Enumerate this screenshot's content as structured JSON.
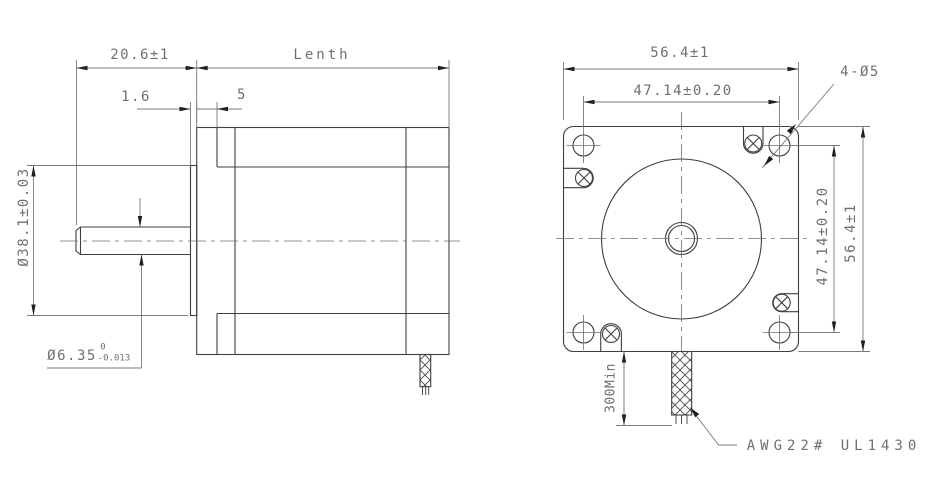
{
  "drawing_type": "stepper-motor-dimension-drawing",
  "colors": {
    "background": "#ffffff",
    "part_line": "#3f3f3f",
    "dim_line": "#7a7a7a",
    "text": "#6f6f6f",
    "arrow": "#1f1f1f"
  },
  "side_view": {
    "shaft_length": "20.6±1",
    "length_label": "Lenth",
    "pilot_depth": "1.6",
    "front_cap_depth": "5",
    "pilot_diameter": "Ø38.1±0.03",
    "shaft_diameter": "Ø6.35",
    "shaft_tol_upper": "0",
    "shaft_tol_lower": "-0.013"
  },
  "front_view": {
    "width": "56.4±1",
    "hole_spacing_horizontal": "47.14±0.20",
    "hole_spacing_vertical": "47.14±0.20",
    "height": "56.4±1",
    "mounting_holes": "4-Ø5",
    "lead_length": "300Min",
    "lead_spec": "AWG22# UL1430"
  }
}
